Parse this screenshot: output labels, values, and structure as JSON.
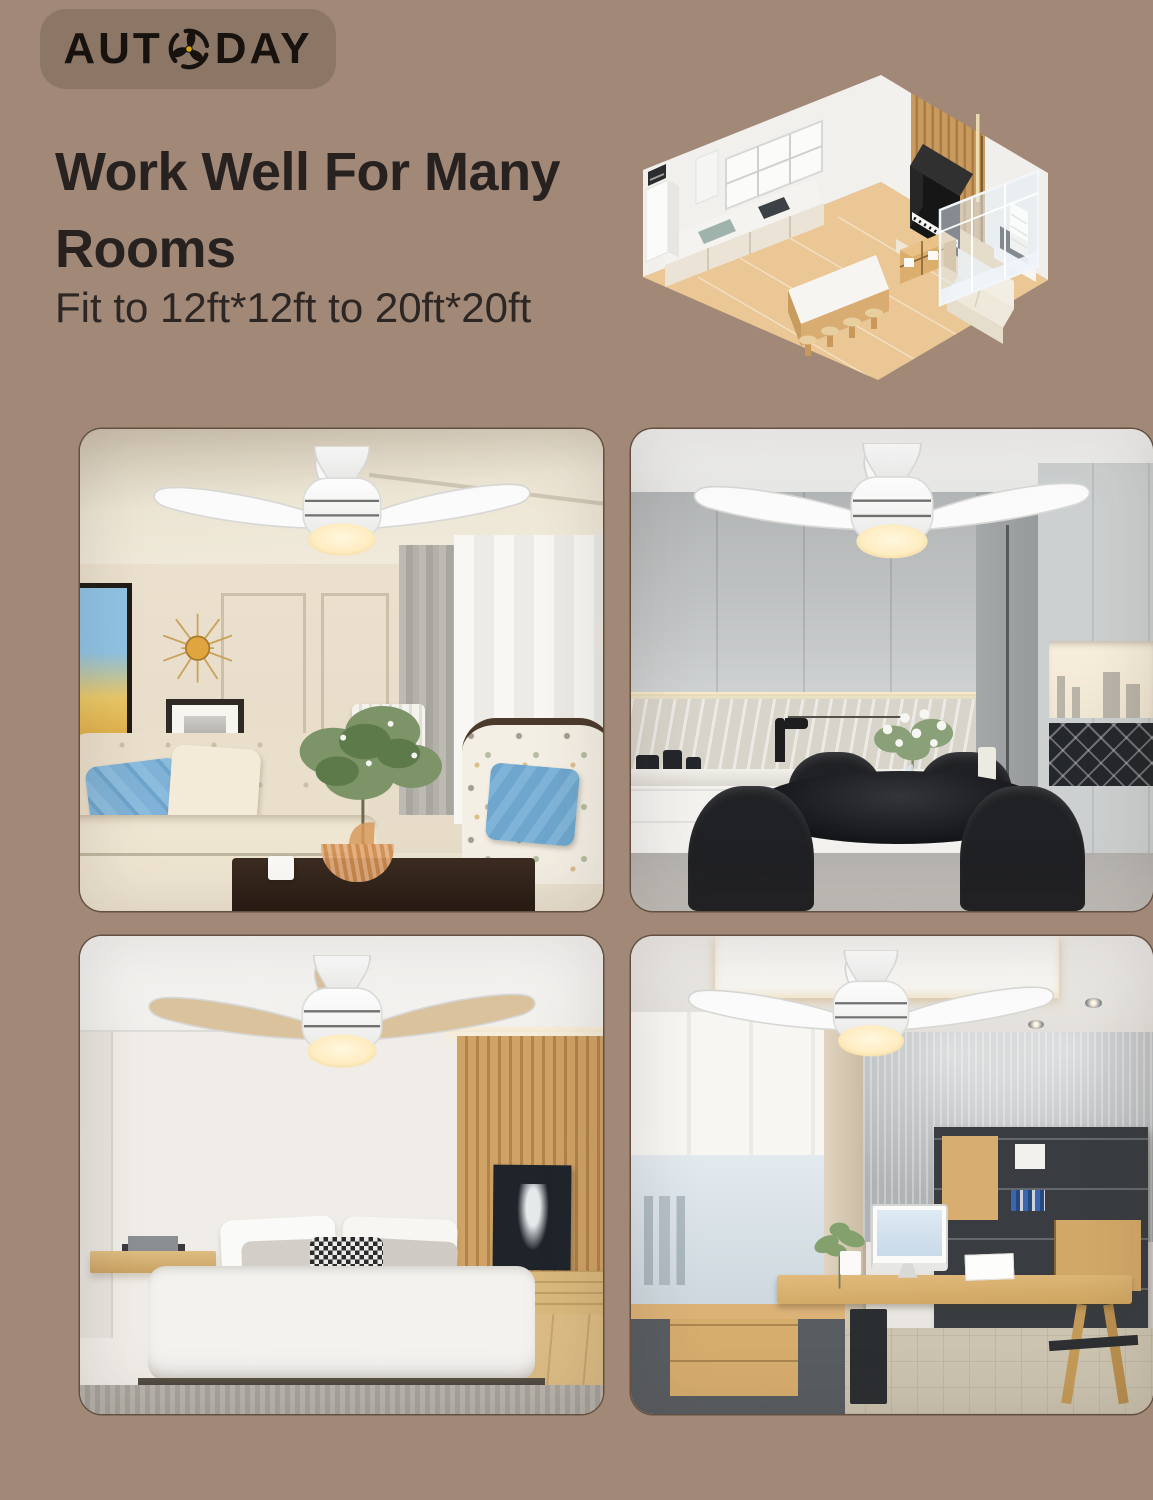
{
  "page": {
    "background": "#a28977"
  },
  "logo": {
    "text_left": "AUT",
    "text_right": "DAY",
    "full_brand": "AUTODAY",
    "badge_bg": "#8c7767",
    "text_color": "#17120e",
    "fan_hub_color": "#d9a414"
  },
  "header": {
    "title_line1": "Work Well For Many",
    "title_line2": "Rooms",
    "subtitle": "Fit to 12ft*12ft to 20ft*20ft",
    "text_color": "#272220"
  },
  "hero": {
    "illustration": "isometric-open-plan-apartment",
    "floor_color": "#eac795",
    "slat_wall_color": "#c89a5e"
  },
  "gallery": {
    "card_corner_radius": "22px",
    "rooms": [
      {
        "id": "living-room",
        "fan_blade_finish": "#fbfbfb"
      },
      {
        "id": "kitchen-dining",
        "fan_blade_finish": "#fbfbfb"
      },
      {
        "id": "bedroom",
        "fan_blade_finish": "#d9c29c"
      },
      {
        "id": "home-office",
        "fan_blade_finish": "#fbfbfb"
      }
    ]
  }
}
